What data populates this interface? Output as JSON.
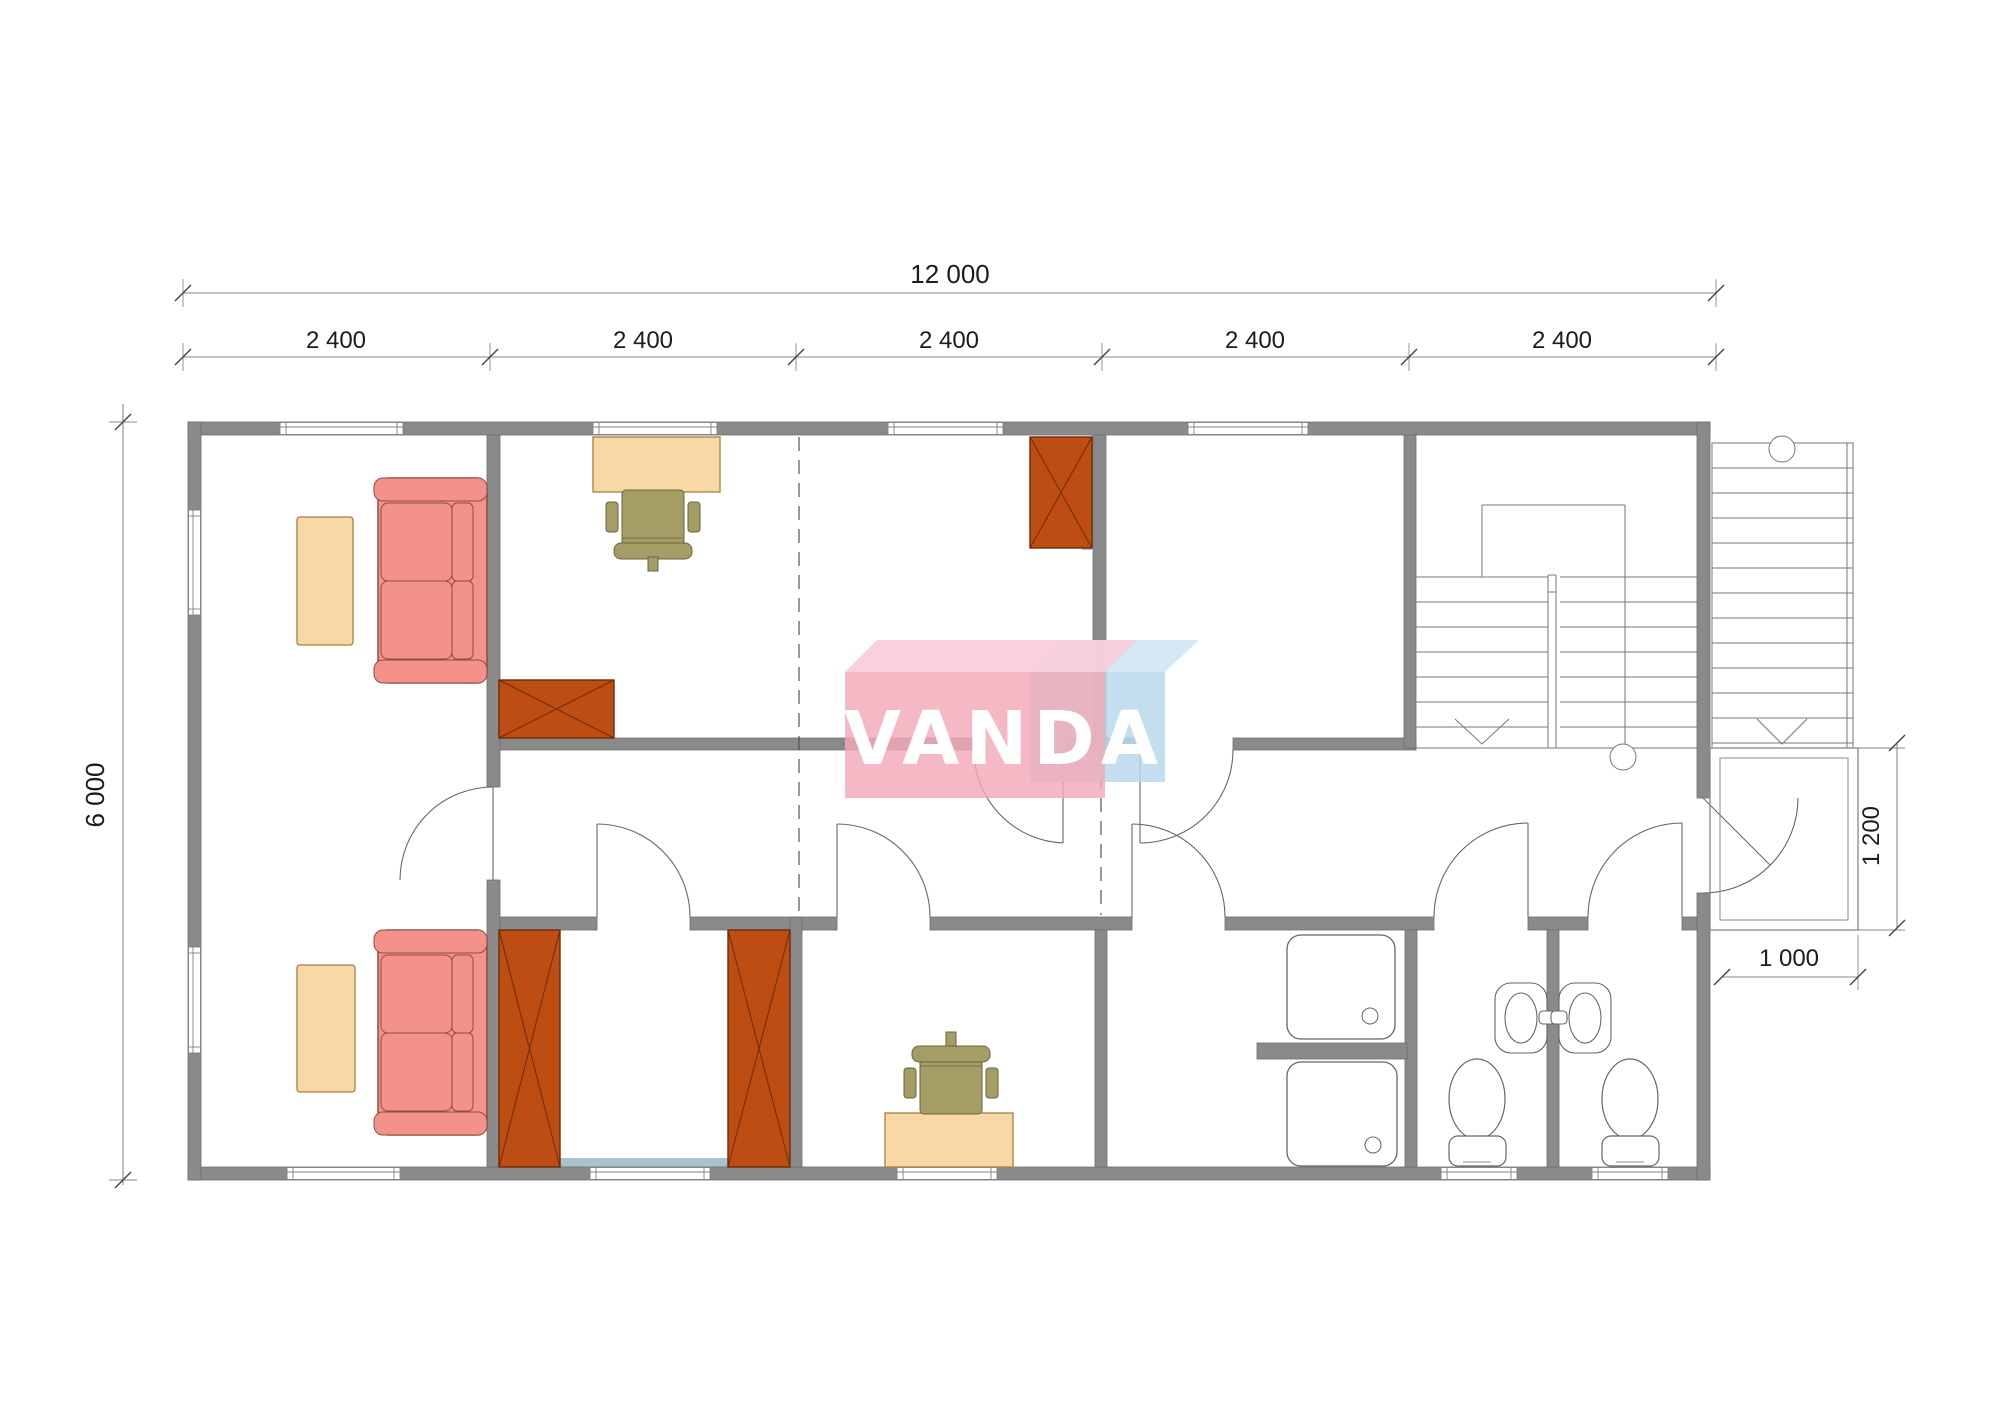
{
  "watermark": {
    "brand": "VANDA"
  },
  "dimensions": {
    "total_width_label": "12 000",
    "bay_labels": [
      "2 400",
      "2 400",
      "2 400",
      "2 400",
      "2 400"
    ],
    "height_label": "6 000",
    "porch_depth_label": "1 200",
    "porch_width_label": "1 000"
  },
  "palette": {
    "wall": "#8a8a8a",
    "wall_accent": "#a7c4ce",
    "sofa": "#f2928b",
    "table": "#f8d8a4",
    "wardrobe": "#be4d13",
    "chair": "#a59d66",
    "fixture_line": "#666666",
    "logo_pink": "#f2a9b8",
    "logo_pink_top": "#f8ccd8",
    "logo_blue": "#b9d9ec",
    "logo_blue_top": "#cfe6f4"
  },
  "furniture": {
    "sofas": 2,
    "coffee_tables": 2,
    "wardrobes": 4,
    "desks": 2,
    "office_chairs": 2,
    "shower_trays": 2,
    "sinks": 2,
    "toilets": 2,
    "interior_staircases": 1,
    "exterior_staircases": 1
  }
}
